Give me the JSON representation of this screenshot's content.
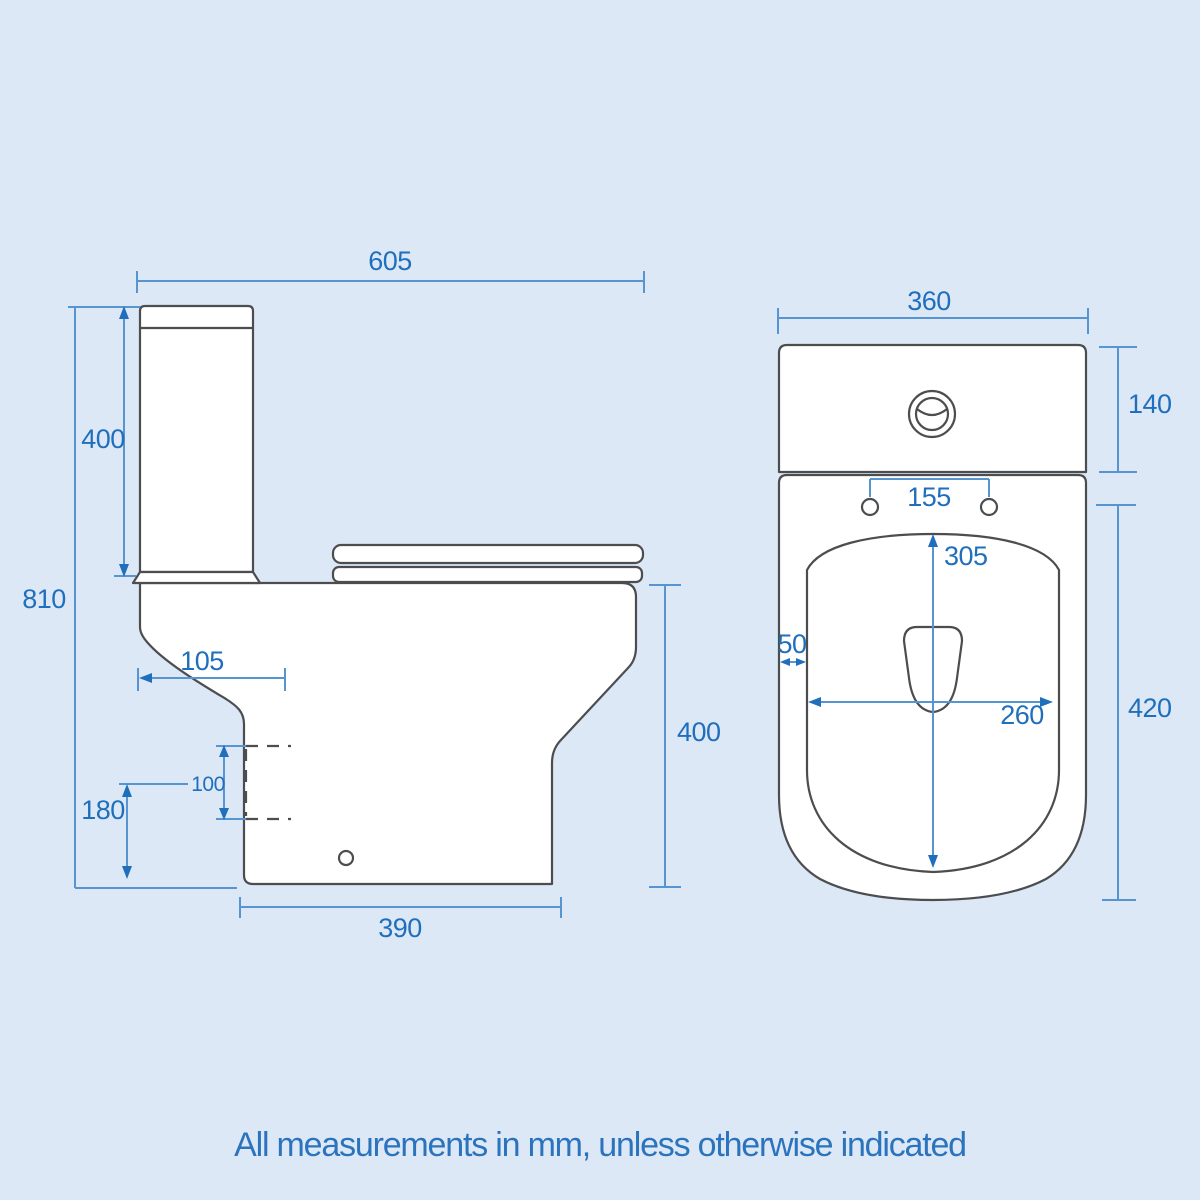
{
  "note": "All measurements in mm, unless otherwise indicated",
  "colors": {
    "background": "#dde8f6",
    "dimension_line": "#5794d2",
    "dimension_accent": "#1f6fbd",
    "outline": "#4c4d4f",
    "fill": "#ffffff"
  },
  "side_view": {
    "dimensions": {
      "overall_width_mm": "605",
      "cistern_height_mm": "400",
      "overall_height_mm": "810",
      "outlet_setback_mm": "105",
      "outlet_size_mm": "100",
      "outlet_centre_height_mm": "180",
      "base_depth_mm": "390",
      "pan_height_mm": "400"
    }
  },
  "front_view": {
    "dimensions": {
      "width_mm": "360",
      "cistern_visible_height_mm": "140",
      "hinge_centres_mm": "155",
      "bowl_length_mm": "305",
      "rim_width_mm": "50",
      "bowl_width_mm": "260",
      "pan_height_mm": "420"
    }
  }
}
